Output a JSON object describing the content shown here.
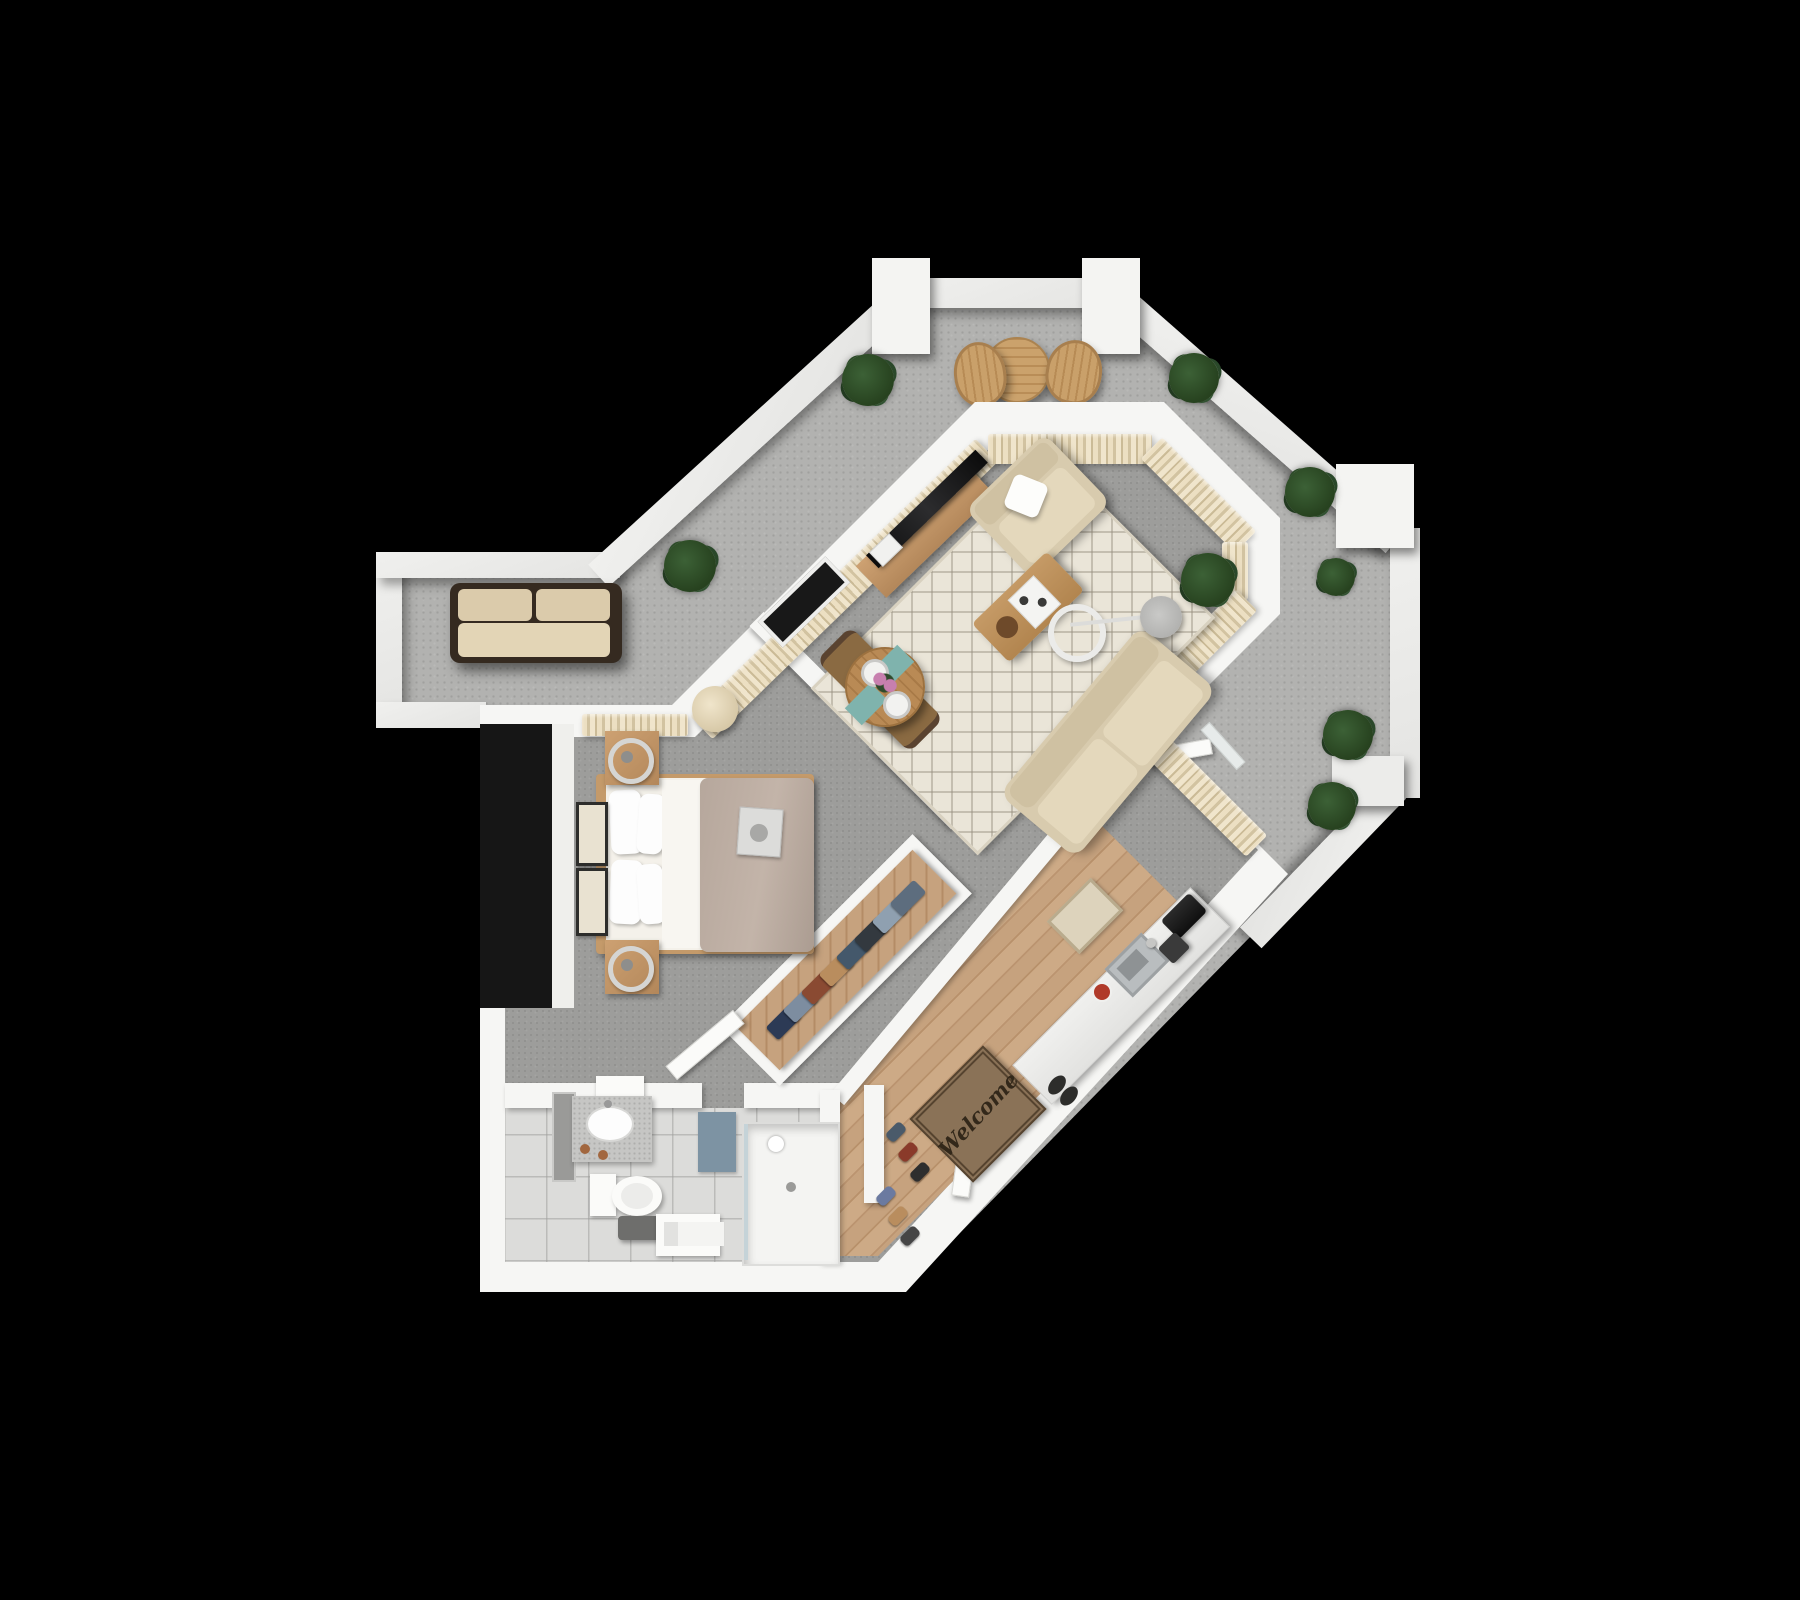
{
  "scene": {
    "kind": "3d-top-down-apartment-floor-plan",
    "background": "#000000"
  },
  "labels": {
    "welcome_mat": "Welcome"
  },
  "palette": {
    "terrace": "#b2b2b0",
    "parapet": "#e4e4e2",
    "wall": "#f6f6f4",
    "carpet": "#9d9d9b",
    "wood": "#c29c76",
    "tile": "#dcdcda",
    "curtain": "#e6dabb",
    "cushion": "#ddd1b5",
    "duvet": "#b6a79c",
    "teal": "#7fb3ad",
    "mat": "#8a7257",
    "plant": "#2e4d2b"
  },
  "terrace": {
    "plants": [
      {
        "x": 690,
        "y": 566,
        "r": 26
      },
      {
        "x": 868,
        "y": 380,
        "r": 26
      },
      {
        "x": 1194,
        "y": 378,
        "r": 25
      },
      {
        "x": 1310,
        "y": 492,
        "r": 25
      },
      {
        "x": 1336,
        "y": 577,
        "r": 19
      },
      {
        "x": 1348,
        "y": 735,
        "r": 25
      },
      {
        "x": 1332,
        "y": 806,
        "r": 24
      }
    ],
    "furniture": [
      "outdoor-sofa",
      "bistro-table",
      "bistro-chair",
      "bistro-chair"
    ]
  },
  "living_room": {
    "plants": [
      {
        "x": 1208,
        "y": 580,
        "r": 27
      }
    ],
    "furniture": [
      "tv-console",
      "tv",
      "area-rug",
      "sofa",
      "armchair",
      "throw-pillow",
      "coffee-table",
      "arc-floor-lamp",
      "dining-table",
      "dining-chair",
      "dining-chair",
      "placemat",
      "placemat",
      "terrace-door"
    ]
  },
  "bedroom": {
    "furniture": [
      "double-bed",
      "pillow",
      "pillow",
      "pillow",
      "pillow",
      "nightstand",
      "nightstand",
      "table-lamp",
      "table-lamp",
      "wall-art",
      "wall-art",
      "bench",
      "breakfast-tray",
      "window"
    ]
  },
  "kitchen": {
    "appliances": [
      "sink",
      "faucet",
      "toaster",
      "coffee-maker"
    ],
    "furniture": [
      "counter",
      "kitchen-rug",
      "welcome-mat",
      "front-door"
    ]
  },
  "bathroom": {
    "fixtures": [
      "mirror",
      "vanity-sink",
      "toilet",
      "stool",
      "towel-bench",
      "bath-mat",
      "walk-in-shower"
    ]
  },
  "closets": {
    "coat_rail": {
      "colors": [
        "#2c3a55",
        "#7d8da0",
        "#8a4a32",
        "#b98d5e",
        "#44586b",
        "#33393f",
        "#8fa0b0",
        "#5d6d7e"
      ]
    },
    "shoe_rack": {
      "items": [
        {
          "x": 896,
          "y": 1132,
          "c": "#4a5a6a"
        },
        {
          "x": 908,
          "y": 1152,
          "c": "#8a3a2a"
        },
        {
          "x": 920,
          "y": 1172,
          "c": "#2e2e2e"
        },
        {
          "x": 886,
          "y": 1196,
          "c": "#6b7aa0"
        },
        {
          "x": 898,
          "y": 1216,
          "c": "#b98d5e"
        },
        {
          "x": 910,
          "y": 1236,
          "c": "#454545"
        }
      ]
    },
    "entry_shoes": [
      {
        "x": 1050,
        "y": 1074
      },
      {
        "x": 1062,
        "y": 1085
      }
    ]
  }
}
